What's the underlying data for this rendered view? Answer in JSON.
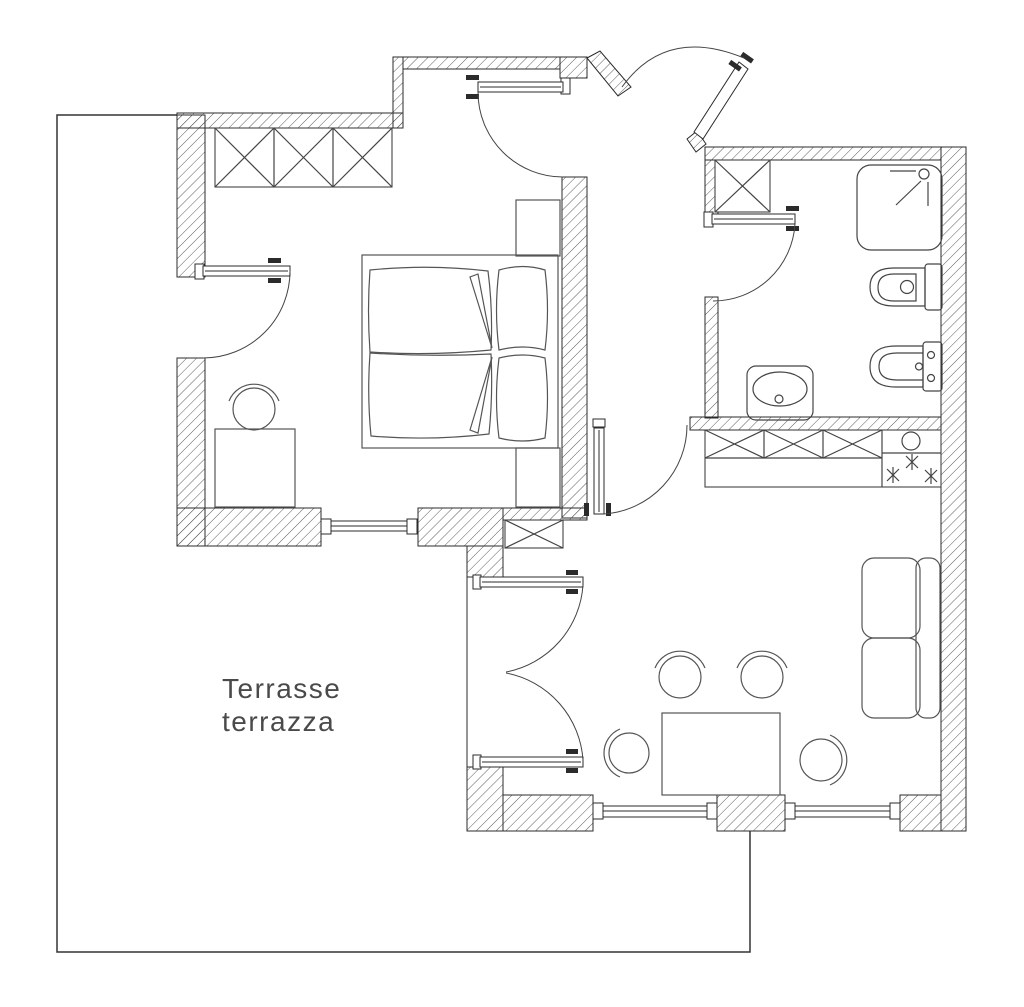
{
  "plan": {
    "terrace_label": {
      "line1": "Terrasse",
      "line2": "terrazza"
    },
    "colors": {
      "background": "#ffffff",
      "wall_line": "#2b2b2b",
      "hatch": "#4a4a4a",
      "furniture_line": "#555555",
      "sanitary_line": "#444444",
      "label_text": "#4a4a4a"
    },
    "elements": {
      "bedroom": [
        "wardrobe-3-sections",
        "double-bed",
        "two-pillows",
        "nightstand-top",
        "nightstand-bottom",
        "desk",
        "desk-chair",
        "terrace-door",
        "entrance-door",
        "window"
      ],
      "bathroom": [
        "closet",
        "shower",
        "toilet",
        "bidet",
        "washbasin",
        "door"
      ],
      "kitchen": [
        "cabinet-row-3-sections",
        "sink",
        "cooktop-3-burners"
      ],
      "living_room": [
        "sofa-2-seat",
        "dining-table",
        "dining-chairs-4",
        "wall-closet",
        "french-double-door",
        "window-left",
        "window-right",
        "hall-door"
      ],
      "exterior": [
        "terrace-outline",
        "entry-door"
      ]
    }
  }
}
